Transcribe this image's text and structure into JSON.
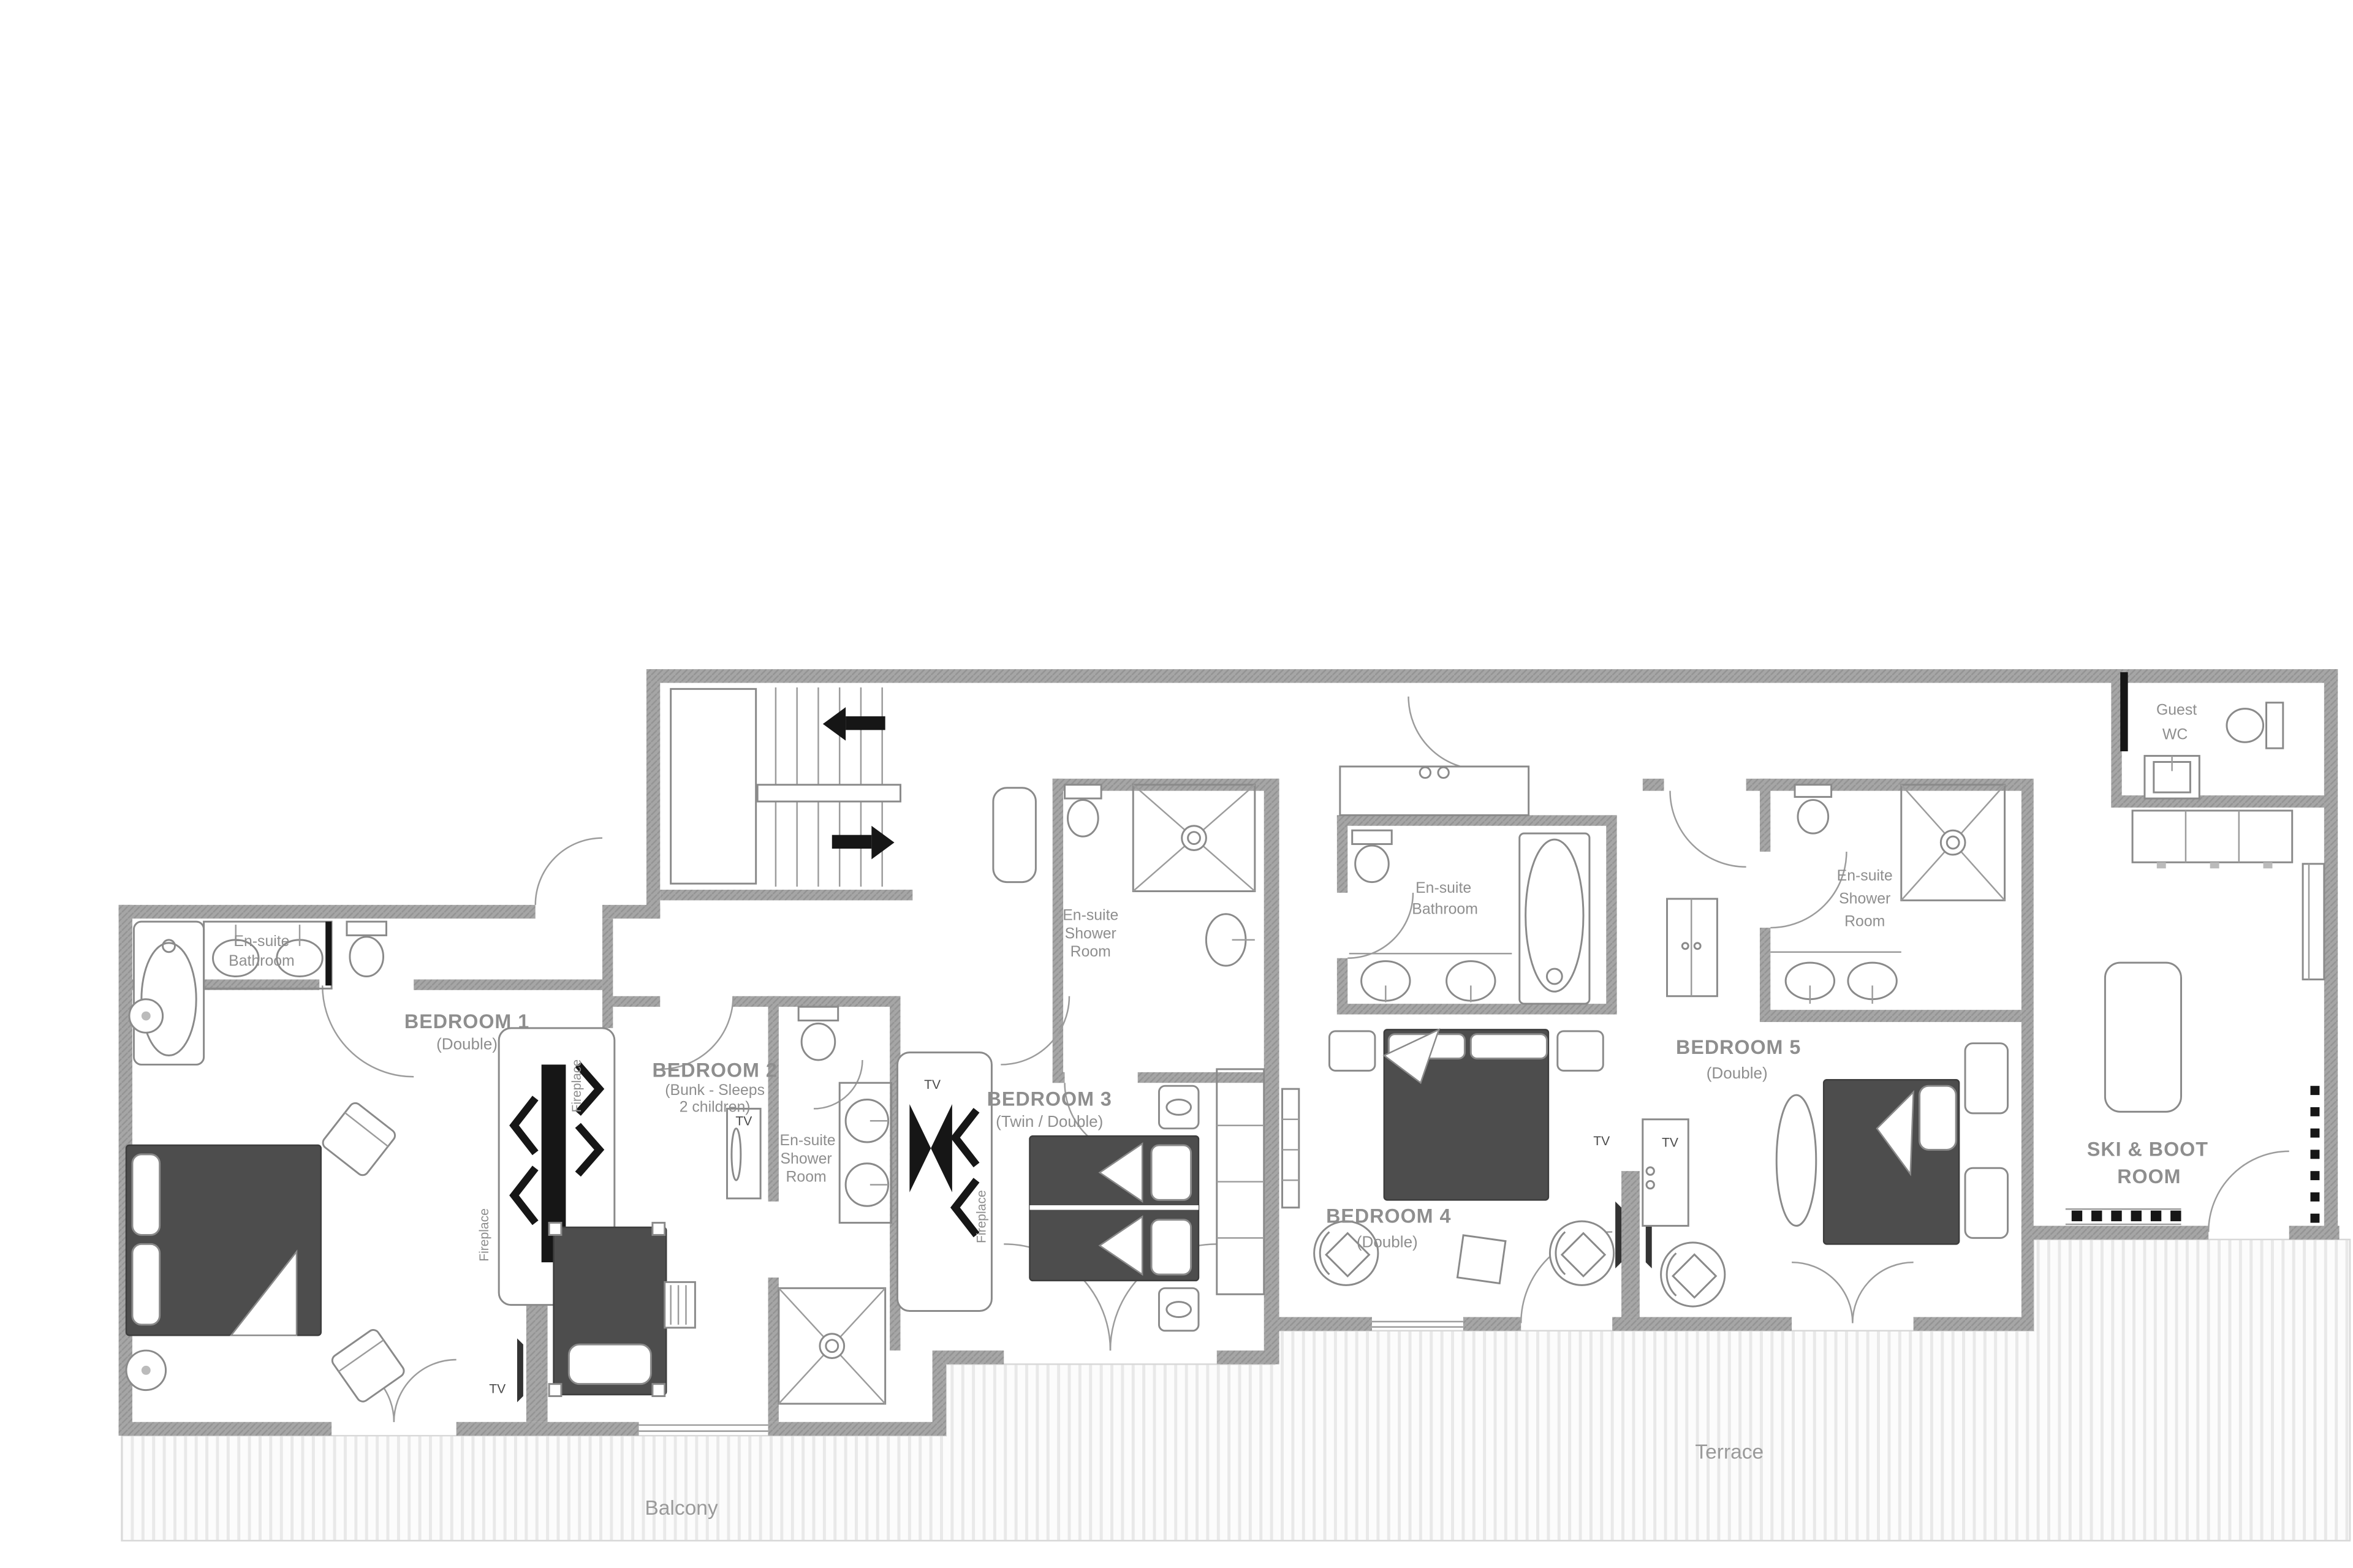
{
  "rooms": {
    "bedroom1": {
      "name": "BEDROOM 1",
      "subtitle": "(Double)"
    },
    "bedroom2": {
      "name": "BEDROOM 2",
      "subtitle1": "(Bunk - Sleeps",
      "subtitle2": "2 children)"
    },
    "bedroom3": {
      "name": "BEDROOM 3",
      "subtitle": "(Twin / Double)"
    },
    "bedroom4": {
      "name": "BEDROOM 4",
      "subtitle": "(Double)"
    },
    "bedroom5": {
      "name": "BEDROOM 5",
      "subtitle": "(Double)"
    },
    "ensuite_bathroom_1": {
      "l1": "En-suite",
      "l2": "Bathroom"
    },
    "ensuite_shower_2": {
      "l1": "En-suite",
      "l2": "Shower",
      "l3": "Room"
    },
    "ensuite_shower_3": {
      "l1": "En-suite",
      "l2": "Shower",
      "l3": "Room"
    },
    "ensuite_bathroom_4": {
      "l1": "En-suite",
      "l2": "Bathroom"
    },
    "ensuite_shower_5": {
      "l1": "En-suite",
      "l2": "Shower",
      "l3": "Room"
    },
    "guest_wc": {
      "l1": "Guest",
      "l2": "WC"
    },
    "ski_boot_room": {
      "l1": "SKI & BOOT",
      "l2": "ROOM"
    },
    "terrace": {
      "name": "Terrace"
    },
    "balcony": {
      "name": "Balcony"
    }
  },
  "annotations": {
    "tv": "TV",
    "fireplace": "Fireplace"
  },
  "colors": {
    "wall": "#a6a6a6",
    "bed_dark": "#4d4d4d",
    "black": "#161616",
    "label_gray": "#8e8e8e",
    "deck_stripe": "#e3e3e3"
  }
}
